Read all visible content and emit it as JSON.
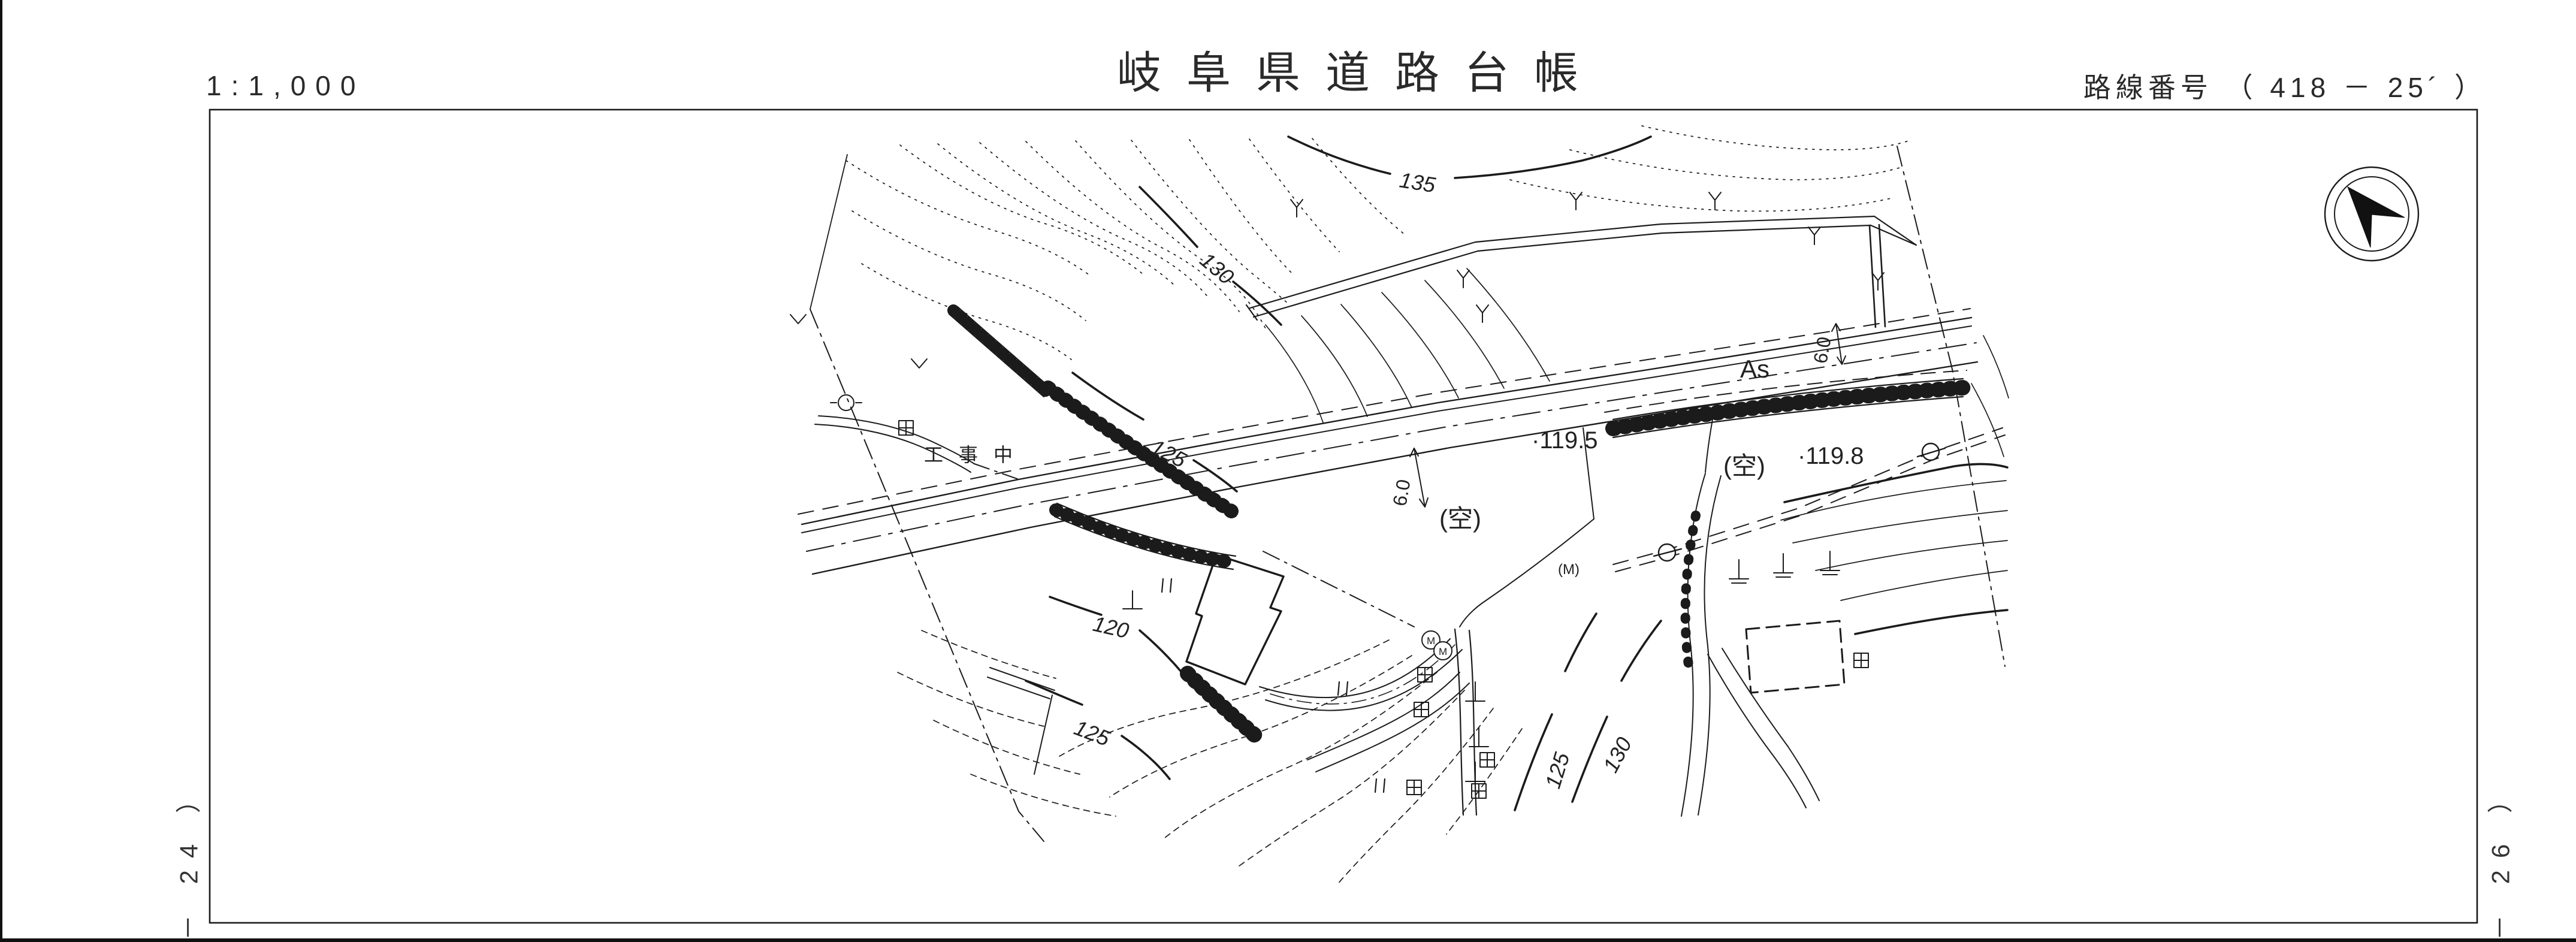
{
  "document": {
    "scale": "1:1,000",
    "title": "岐阜県道路台帳",
    "route_number": "路線番号 （ 418 － 25´ ）",
    "adjacent_sheet_left": "－ 24 ）",
    "adjacent_sheet_right": "－ 26 ）"
  },
  "map": {
    "annotations": {
      "road_surface": "As",
      "spot_elevation_1": "·119.5",
      "spot_elevation_2": "·119.8",
      "vacant_lot_1": "(空)",
      "vacant_lot_2": "(空)",
      "under_construction": "工事中",
      "road_width_1": "6.0",
      "road_width_2": "6.0",
      "manhole_1": "M",
      "manhole_2": "M",
      "manhole_3": "(M)"
    },
    "contour_labels": {
      "c135": "135",
      "c130_upper": "130",
      "c125_upper": "125",
      "c120": "120",
      "c125_lower_left": "125",
      "c125_lower_right": "125",
      "c130_lower_right": "130"
    },
    "colors": {
      "ink": "#1b1b1b",
      "paper": "#ffffff"
    }
  }
}
